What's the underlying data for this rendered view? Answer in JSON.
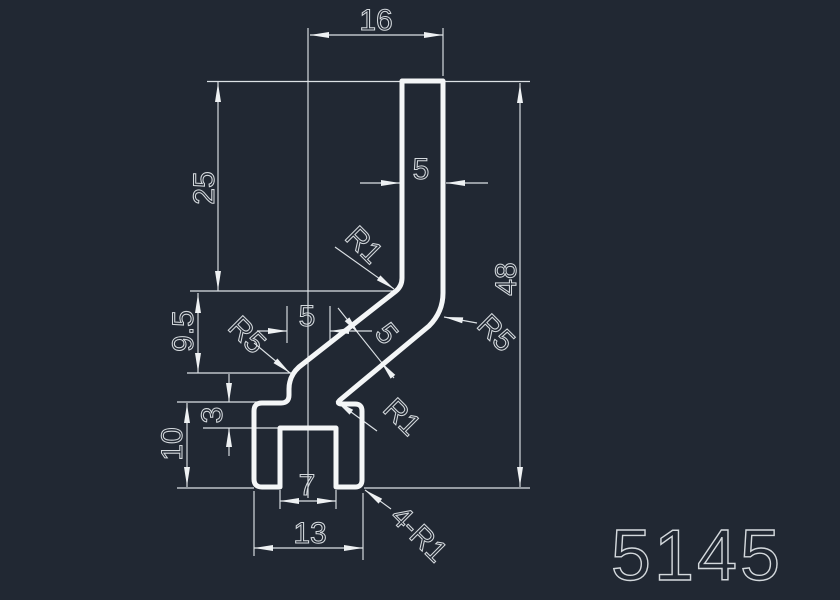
{
  "part_number": "5145",
  "colors": {
    "background": "#212833",
    "line": "#e8ecef",
    "text": "#d4d9dd"
  },
  "dimensions": {
    "top_width": "16",
    "bar_thickness": "5",
    "upper_height": "25",
    "bend_height": "9.5",
    "step_height": "3",
    "foot_height": "10",
    "slot_width": "7",
    "base_width": "13",
    "overall_height": "48",
    "land_width": "5",
    "wall_thickness": "5"
  },
  "radii_labels": {
    "bend_inner": "R1",
    "bend_outer": "R5",
    "transition": "R5",
    "land_fillet": "R1",
    "corner_fillets": "4-R1"
  }
}
